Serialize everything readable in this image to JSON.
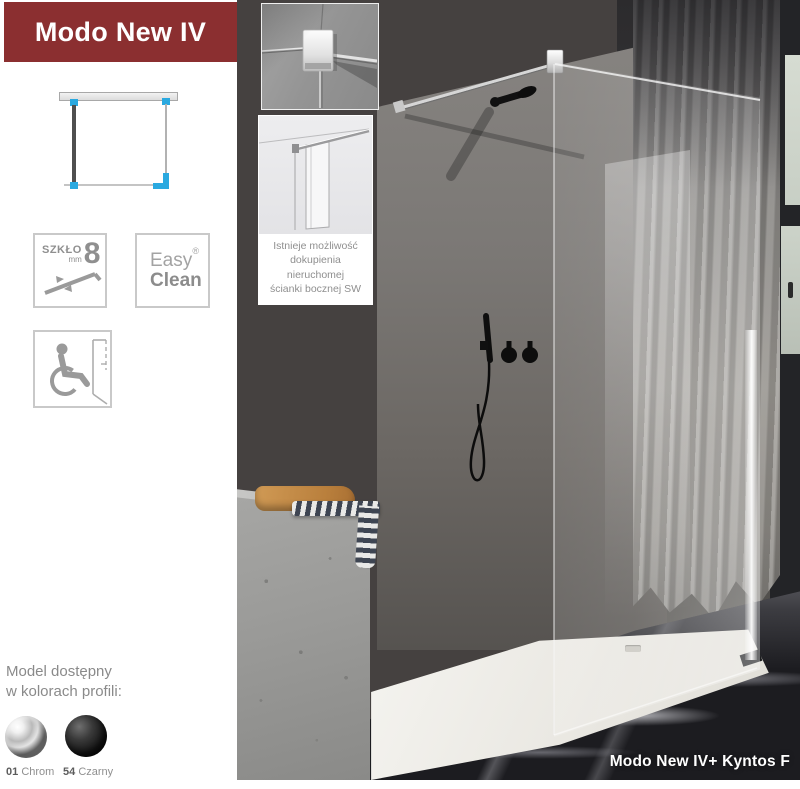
{
  "banner": {
    "title": "Modo New IV",
    "bg": "#8b2f30"
  },
  "badges": {
    "glass": {
      "label": "SZKŁO",
      "unit": "mm",
      "value": "8"
    },
    "easy_clean": {
      "word1": "Easy",
      "word2": "Clean",
      "registered": "®"
    }
  },
  "inset_note": {
    "line1": "Istnieje możliwość",
    "line2": "dokupienia",
    "line3": "nieruchomej",
    "line4": "ścianki bocznej SW"
  },
  "profile_colors": {
    "heading_line1": "Model dostępny",
    "heading_line2": "w kolorach profili:",
    "options": [
      {
        "code": "01",
        "name": "Chrom",
        "color": "#b9b9b9"
      },
      {
        "code": "54",
        "name": "Czarny",
        "color": "#1c1c1c"
      }
    ]
  },
  "photo": {
    "caption": "Modo New IV+ Kyntos F"
  },
  "palette": {
    "accent_blue": "#2aa9e0",
    "icon_gray": "#9a9a9a",
    "caption_color": "#ffffff"
  }
}
